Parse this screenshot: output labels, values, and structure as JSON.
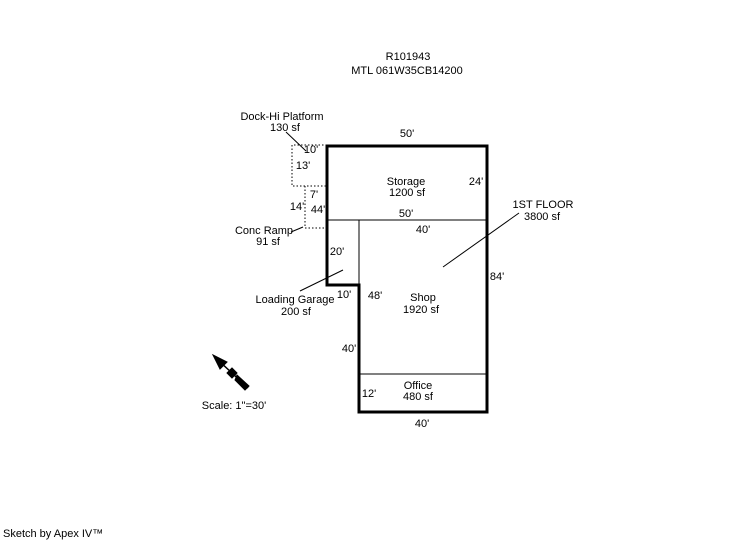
{
  "title": {
    "record_id": "R101943",
    "parcel_id": "MTL  061W35CB14200"
  },
  "areas": {
    "dock": {
      "name": "Dock-Hi Platform",
      "area": "130 sf"
    },
    "ramp": {
      "name": "Conc Ramp",
      "area": "91 sf"
    },
    "garage": {
      "name": "Loading Garage",
      "area": "200 sf"
    },
    "storage": {
      "name": "Storage",
      "area": "1200 sf"
    },
    "shop": {
      "name": "Shop",
      "area": "1920 sf"
    },
    "office": {
      "name": "Office",
      "area": "480 sf"
    },
    "first_floor": {
      "name": "1ST FLOOR",
      "area": "3800 sf"
    }
  },
  "dims": {
    "storage_north": "50'",
    "dock_north": "10'",
    "dock_west": "13'",
    "ramp_north": "7'",
    "ramp_west": "14'",
    "west_wall": "44'",
    "storage_east": "24'",
    "storage_south": "50'",
    "shop_north": "40'",
    "garage_west": "20'",
    "garage_south": "10'",
    "shop_west": "48'",
    "east_wall": "84'",
    "west_lower_wall": "40'",
    "office_west": "12'",
    "office_south": "40'"
  },
  "scale_label": "Scale: 1\"=30'",
  "footer": "Sketch by Apex IV™",
  "colors": {
    "line": "#000000",
    "background": "#ffffff"
  }
}
